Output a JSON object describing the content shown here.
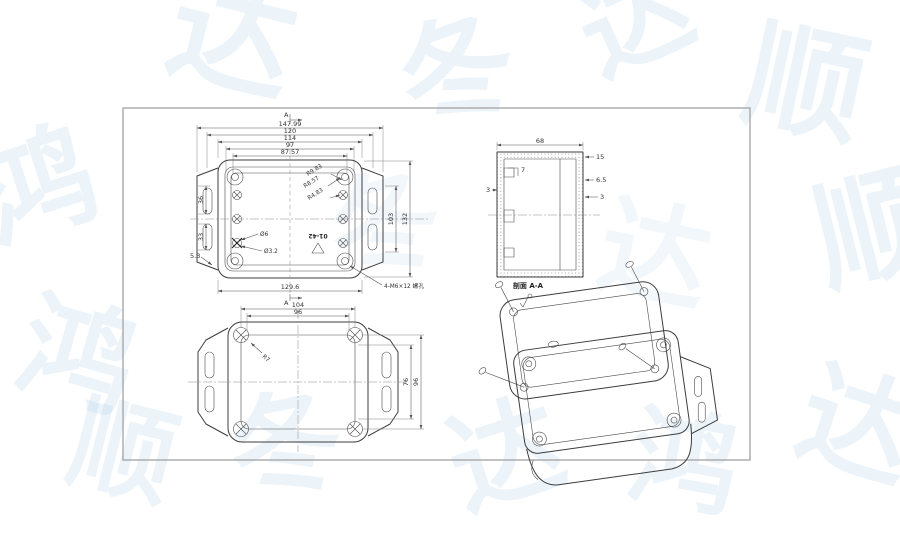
{
  "watermark": {
    "chars": [
      "鸿",
      "达",
      "冬",
      "顺"
    ]
  },
  "drawing": {
    "section_label": "A",
    "top_view": {
      "dims_top": [
        "147.99",
        "120",
        "114",
        "97",
        "87.57"
      ],
      "dims_left": [
        "36",
        "33"
      ],
      "dim_corner": "5.3",
      "dims_right": [
        "103",
        "132"
      ],
      "dim_bottom": "129.6",
      "hole_callouts": [
        "Ø6",
        "Ø3.2"
      ],
      "radius_callouts": [
        "R9.83",
        "R8.57",
        "R4.83"
      ],
      "marking": "01-42",
      "thread_callout": "4-M6×12 螺孔"
    },
    "section_view": {
      "dim_top": "68",
      "dims_right": [
        "15",
        "6.5",
        "3"
      ],
      "dims_left": [
        "7",
        "3"
      ],
      "caption": "剖面 A-A"
    },
    "bottom_view": {
      "dims_top": [
        "104",
        "96"
      ],
      "dims_right": [
        "76",
        "96"
      ],
      "radius_callout": "R7"
    }
  }
}
